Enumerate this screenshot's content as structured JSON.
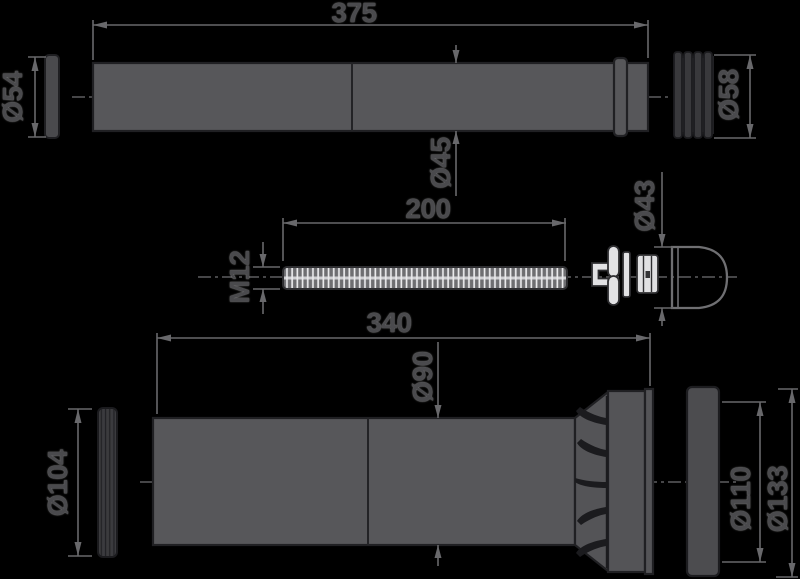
{
  "drawing": {
    "title": "wc-connector-set-technical-drawing",
    "background_color": "#000000",
    "part_fill_color": "#57575a",
    "dimension_line_color": "#68686b",
    "text_color": "#4a4a4d",
    "dimensions": {
      "top_pipe_length": "375",
      "top_left_gasket_diameter": "Ø54",
      "top_pipe_diameter": "Ø45",
      "top_right_sleeve_diameter": "Ø58",
      "rod_length": "200",
      "rod_thread": "M12",
      "cone_cap_diameter": "Ø43",
      "bottom_pipe_length": "340",
      "bottom_pipe_diameter": "Ø90",
      "bottom_left_gasket_diameter": "Ø104",
      "bottom_socket_inner_diameter": "Ø110",
      "bottom_socket_outer_diameter": "Ø133"
    }
  }
}
